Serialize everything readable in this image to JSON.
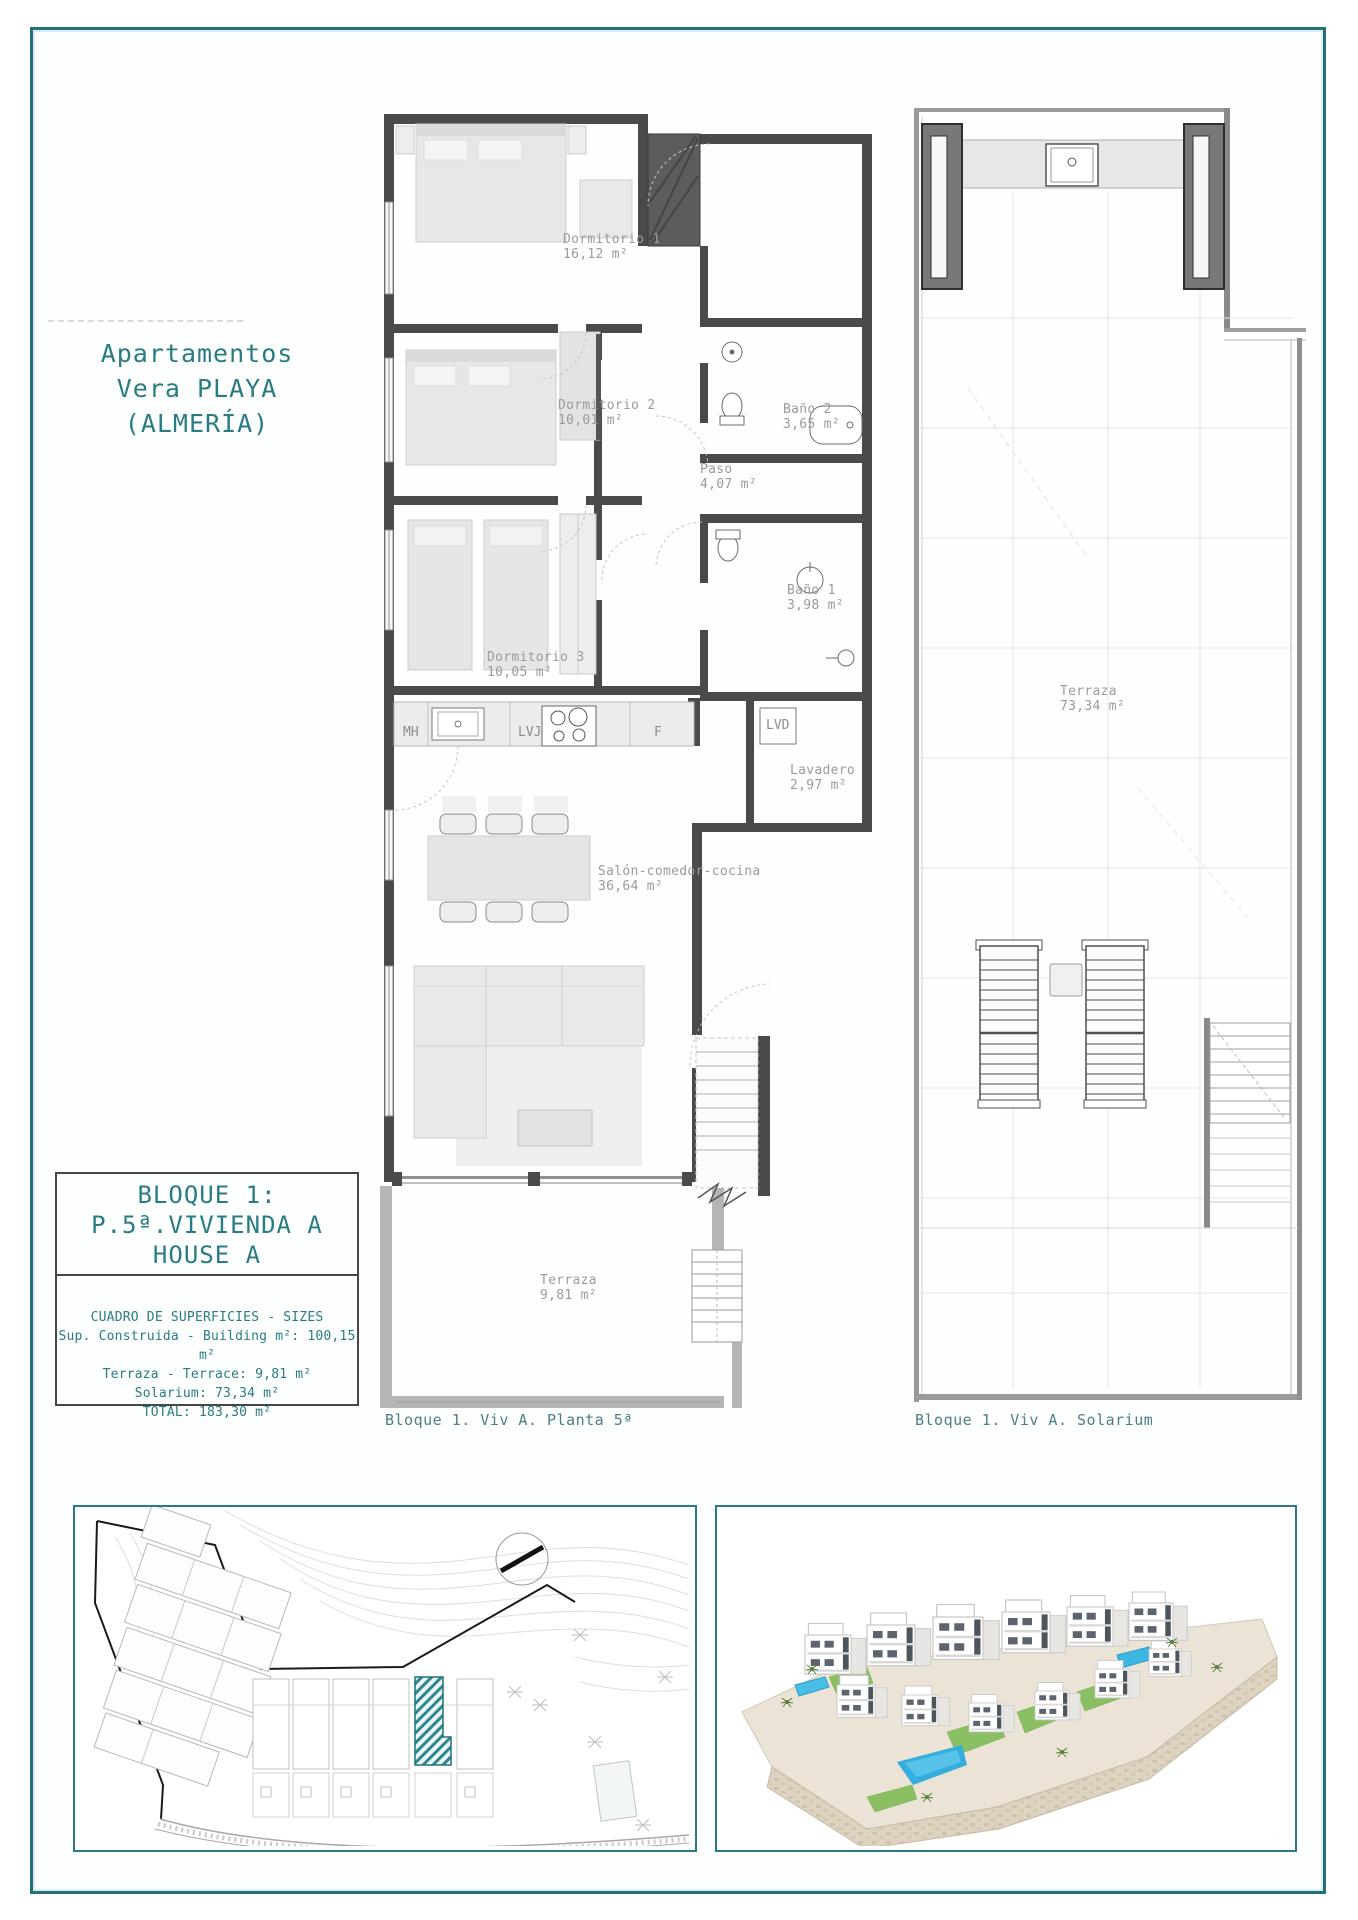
{
  "header": {
    "title_lines": [
      "Apartamentos",
      "Vera PLAYA",
      "(ALMERÍA)"
    ]
  },
  "floor_plan": {
    "caption": "Bloque 1. Viv A. Planta 5ª",
    "rooms": [
      {
        "name": "Dormitorio 1",
        "area": "16,12 m²"
      },
      {
        "name": "Dormitorio 2",
        "area": "10,01 m²"
      },
      {
        "name": "Baño 2",
        "area": "3,65 m²"
      },
      {
        "name": "Paso",
        "area": "4,07 m²"
      },
      {
        "name": "Baño 1",
        "area": "3,98 m²"
      },
      {
        "name": "Dormitorio 3",
        "area": "10,05 m²"
      },
      {
        "name": "Lavadero",
        "area": "2,97 m²"
      },
      {
        "name": "Salón-comedor-cocina",
        "area": "36,64 m²"
      },
      {
        "name": "Terraza",
        "area": "9,81 m²"
      }
    ],
    "appliances": {
      "microwave": "MH",
      "dishwasher": "LVJ",
      "fridge": "F",
      "washer": "LVD"
    }
  },
  "solarium_plan": {
    "caption": "Bloque 1. Viv A. Solarium",
    "rooms": [
      {
        "name": "Terraza",
        "area": "73,34 m²"
      }
    ]
  },
  "info_box": {
    "block_lines": [
      "BLOQUE 1:",
      "P.5ª.VIVIENDA A",
      "HOUSE A"
    ],
    "sizes_title": "CUADRO DE SUPERFICIES - SIZES",
    "sizes_rows": [
      "Sup. Construida - Building m²: 100,15 m²",
      "Terraza - Terrace: 9,81 m²",
      "Solarium: 73,34 m²",
      "TOTAL: 183,30 m²"
    ]
  },
  "colors": {
    "accent": "#2a7c82",
    "frame": "#266e78",
    "wall": "#4a4a4a",
    "label_gray": "#9b9b9b"
  }
}
